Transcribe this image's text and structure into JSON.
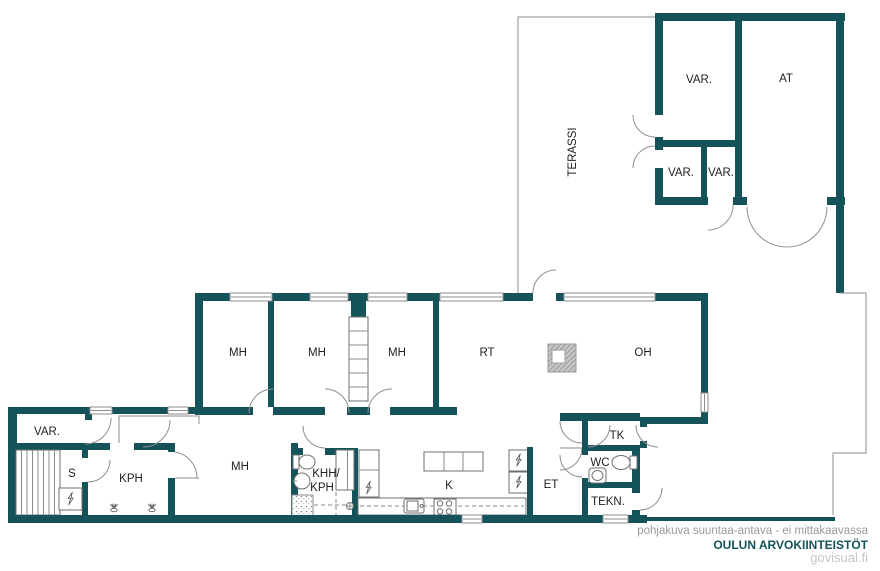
{
  "plan": {
    "colors": {
      "wall": "#15535a",
      "line": "#8c8c8c",
      "label": "#222222"
    },
    "rooms": {
      "garage_storage": "VAR.",
      "garage": "AT",
      "storage_small_left": "VAR.",
      "storage_small_right": "VAR.",
      "terrace": "TERASSI",
      "bedroom_1": "MH",
      "bedroom_2": "MH",
      "bedroom_3": "MH",
      "dining_room": "RT",
      "living_room": "OH",
      "storage_west": "VAR.",
      "sauna": "S",
      "bathroom": "KPH",
      "bedroom_4": "MH",
      "utility_room_line1": "KHH/",
      "utility_room_line2": "KPH",
      "kitchen": "K",
      "entry": "ET",
      "vestibule": "TK",
      "wc": "WC",
      "technical_room": "TEKN."
    }
  },
  "footer": {
    "disclaimer": "pohjakuva suuntaa-antava - ei mittakaavassa",
    "company": "OULUN ARVOKIINTEISTÖT",
    "website": "govisual.fi"
  }
}
